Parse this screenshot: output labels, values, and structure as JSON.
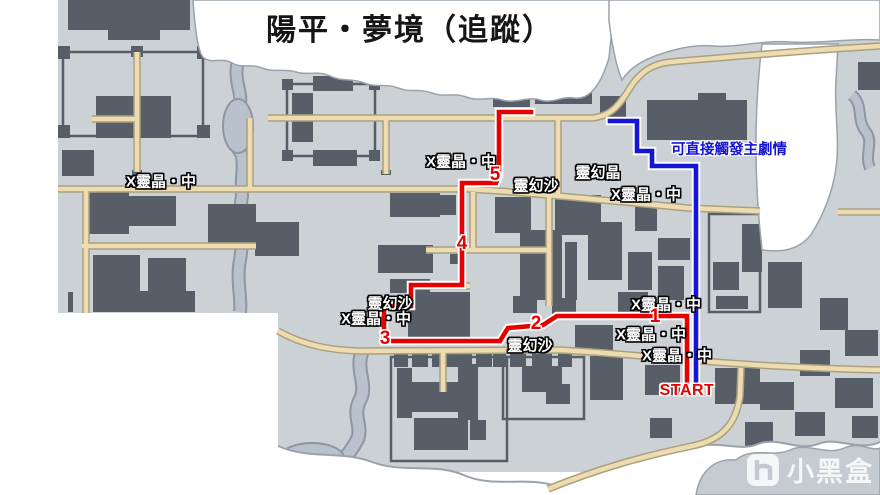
{
  "title": "陽平・夢境（追蹤）",
  "annotation": {
    "text": "可直接觸發主劇情",
    "color": "#1414d2"
  },
  "routes": {
    "red": {
      "color": "#e60000",
      "points": "531,112 499,112 499,176 496,183 462,183 462,285 411,285 411,306 384,306 384,341 500,341 508,328 543,325 557,316 687,316 687,384"
    },
    "blue": {
      "color": "#1515d6",
      "points": "610,121 637,121 637,151 652,151 652,166 696,166 696,384"
    }
  },
  "waypoints": [
    {
      "label": "5",
      "x": 495,
      "y": 175
    },
    {
      "label": "4",
      "x": 462,
      "y": 244
    },
    {
      "label": "3",
      "x": 385,
      "y": 339
    },
    {
      "label": "2",
      "x": 536,
      "y": 324
    },
    {
      "label": "1",
      "x": 655,
      "y": 317
    },
    {
      "label": "START",
      "x": 687,
      "y": 391
    }
  ],
  "map_labels": [
    {
      "text": "X靈晶・中",
      "x": 161,
      "y": 181
    },
    {
      "text": "X靈晶・中",
      "x": 461,
      "y": 161
    },
    {
      "text": "靈幻沙",
      "x": 536,
      "y": 185
    },
    {
      "text": "靈幻晶",
      "x": 598,
      "y": 172
    },
    {
      "text": "X靈晶・中",
      "x": 646,
      "y": 194
    },
    {
      "text": "靈幻沙",
      "x": 390,
      "y": 303
    },
    {
      "text": "X靈晶・中",
      "x": 376,
      "y": 318
    },
    {
      "text": "靈幻沙",
      "x": 530,
      "y": 345
    },
    {
      "text": "X靈晶・中",
      "x": 666,
      "y": 304
    },
    {
      "text": "X靈晶・中",
      "x": 651,
      "y": 334
    },
    {
      "text": "X靈晶・中",
      "x": 677,
      "y": 355
    }
  ],
  "watermark": {
    "text": "小黑盒"
  }
}
